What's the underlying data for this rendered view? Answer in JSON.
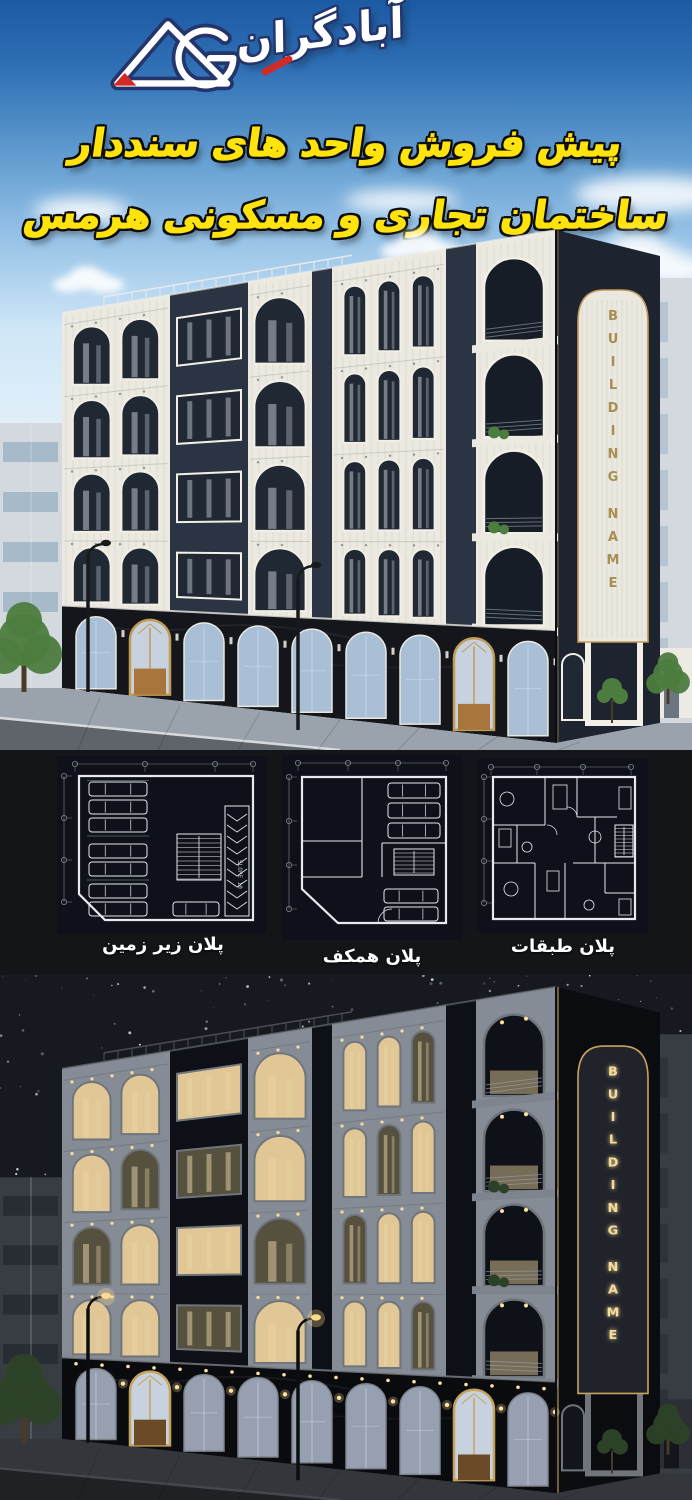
{
  "poster": {
    "logo": {
      "monogram": "AG",
      "brand_name": "آبادگران"
    },
    "headline": {
      "line1": "پیش فروش واحد های سنددار",
      "line2": "ساختمان تجاری و مسکونی هرمس"
    },
    "day_render": {
      "sign_text": "BUILDING NAME"
    },
    "night_render": {
      "sign_text": "BUILDING NAME"
    },
    "floor_plans": {
      "items": [
        {
          "caption": "پلان زیر زمین",
          "annotation": "SLOPE 10"
        },
        {
          "caption": "پلان همکف"
        },
        {
          "caption": "پلان طبقات"
        }
      ]
    },
    "colors": {
      "headline_yellow": "#ffe30d",
      "outline_black": "#0d0d0d",
      "logo_fill": "#ffffff",
      "logo_outline": "#23356b",
      "logo_red": "#d22b27",
      "sky_top": "#1c5ba4",
      "sky_light": "#cfe7f7",
      "navy_facade": "#2a3442",
      "cream_panel": "#ece9e0",
      "gold_trim": "#c19b58",
      "wood_door": "#a8763c",
      "marble_black": "#14161b",
      "shop_glass": "#a9bfd6",
      "street_day": "#9aa2ab",
      "tree_green": "#4d7c3f",
      "strip_background": "#141519",
      "plan_background": "#0e1119",
      "plan_line": "#e6eaef",
      "night_sky": "#171921",
      "window_glow": "#e0c795",
      "sign_gold_glow": "#f5dc9b",
      "night_street": "#33363b"
    }
  }
}
